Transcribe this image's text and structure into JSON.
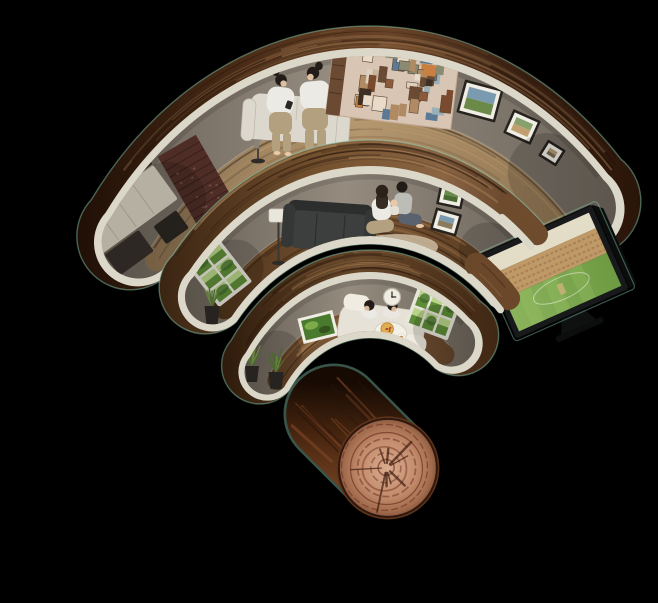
{
  "scene": {
    "alt": "Illustration of a Wi-Fi symbol built from three curved cutaway home interiors; the dot of the symbol is a cut wooden log",
    "bars": [
      {
        "name": "wifi-bar-top",
        "items": [
          "kitchen-units",
          "brick-wall",
          "yellow-floor-lamp",
          "cream-sofa",
          "couple-on-smartphones",
          "picture-collage-wall",
          "framed-pictures"
        ]
      },
      {
        "name": "wifi-bar-middle",
        "items": [
          "garden-window",
          "potted-plant",
          "white-floor-lamp",
          "charcoal-sofa",
          "family-on-rug",
          "framed-pictures",
          "sports-tv"
        ]
      },
      {
        "name": "wifi-bar-small",
        "items": [
          "green-wall-art",
          "couple-eating-on-sofa",
          "wall-clock",
          "garden-window",
          "potted-plants"
        ]
      }
    ],
    "dot": {
      "name": "wifi-dot-log"
    }
  },
  "palette": {
    "background": "#000000",
    "edge_glow": "#8fd4b8",
    "trim_cream": "#dbd7c9",
    "trim_shadow": "#b9b4a4",
    "grain_dark": "#170b04",
    "grain_light": "#c49a6a",
    "brick": "#4e2d26",
    "brick_line": "#2f1a16",
    "brick_fleck": "#8a5f50",
    "cabinet": "#d6cfc0",
    "cabinet_seam": "#b9b1a2",
    "counter_dark": "#332c25",
    "appliance_dark": "#35302a",
    "sofa_cream": "#ddd8cd",
    "sofa_cream_shadow": "#bcb6a9",
    "sofa_charcoal": "#3c3f3e",
    "sofa_charcoal_dark": "#2b2e2d",
    "lamp_yellow": "#e2a43c",
    "lamp_white": "#e9e6dc",
    "lamp_pole": "#4a4440",
    "skin": "#e9c9a8",
    "hair_dark": "#221c18",
    "hair_brown": "#2c2219",
    "shirt_white": "#eceae4",
    "tee_gray": "#bdbdb8",
    "pants_khaki": "#b3a07f",
    "jeans_blue": "#5a6270",
    "rug_beige": "#c9b89e",
    "frame_dark": "#26221e",
    "frame_mat": "#f0ede4",
    "art_green_1": "#4a7a2e",
    "art_green_2": "#8ab84e",
    "collage_base": "#d8c5b3",
    "collage_edge": "#c0a892",
    "collage_shelf": "#6b4a33",
    "collage_tones": [
      "#8a5a3a",
      "#b08a62",
      "#5a7a96",
      "#c8b49c",
      "#7a4a2e",
      "#ddd0bc",
      "#3f2f22",
      "#c97f3f",
      "#9ab0b8",
      "#6b4a33",
      "#e8dcc8",
      "#8a8a72"
    ],
    "window_frame": "#e8e5da",
    "garden_light": "#b8d488",
    "garden_dark": "#5f8c38",
    "garden_tree": "#3f6b2a",
    "plant_green_1": "#5a7a3a",
    "plant_green_2": "#7a9a4a",
    "pot_dark": "#2e2a26",
    "tv_bezel": "#17191a",
    "tv_side": "#0b0d0d",
    "tv_sky": "#e3dcc6",
    "tv_stands": "#c09a66",
    "tv_stands_dark": "#a9825a",
    "tv_pitch": "#c9b078",
    "tv_line": "#eef0e2",
    "tv_stand_leg": "#0f1111",
    "clock_face": "#efece2",
    "clock_hand": "#2a2622",
    "overlay_wood": "#6e4b2c",
    "overlay_floor": "#6b482a",
    "log_ring": "#7a3a28",
    "log_crack": "#3f1d10",
    "log_edge": "#2e1810",
    "log_bark_hi": "#7c4526",
    "log_bark_lo": "#2a140a",
    "wall_shadow": "#000000"
  },
  "gradients": {
    "gWood1": [
      [
        "0%",
        "#200f06"
      ],
      [
        "30%",
        "#4a2c17"
      ],
      [
        "55%",
        "#6b4428"
      ],
      [
        "80%",
        "#3a2112"
      ],
      [
        "100%",
        "#2a1509"
      ]
    ],
    "gWood2": [
      [
        "0%",
        "#3a2412"
      ],
      [
        "40%",
        "#75522f"
      ],
      [
        "70%",
        "#8a6443"
      ],
      [
        "100%",
        "#4c2f1a"
      ]
    ],
    "gWood3": [
      [
        "0%",
        "#2e1b0c"
      ],
      [
        "50%",
        "#684729"
      ],
      [
        "100%",
        "#3f2714"
      ]
    ],
    "gWall": [
      [
        "0%",
        "#6a6258"
      ],
      [
        "45%",
        "#958b7f"
      ],
      [
        "100%",
        "#6e665c"
      ]
    ],
    "gFloor1": [
      [
        "0%",
        "#8a7050"
      ],
      [
        "50%",
        "#b3976f"
      ],
      [
        "100%",
        "#8f7452"
      ]
    ],
    "gFloor2": [
      [
        "0%",
        "#4c3119"
      ],
      [
        "45%",
        "#7a5635"
      ],
      [
        "100%",
        "#583a20"
      ]
    ],
    "gFloor3": [
      [
        "0%",
        "#5a3c22"
      ],
      [
        "50%",
        "#8a6440"
      ],
      [
        "100%",
        "#64452a"
      ]
    ],
    "gField": [
      [
        "0%",
        "#8ab35c"
      ],
      [
        "100%",
        "#6d9a42"
      ]
    ],
    "gBark": [
      [
        "0%",
        "#160a03"
      ],
      [
        "40%",
        "#4c2811"
      ],
      [
        "70%",
        "#6e3e1f"
      ],
      [
        "100%",
        "#2e1608"
      ]
    ],
    "gFace": [
      [
        "0%",
        "#d9ab8e"
      ],
      [
        "55%",
        "#c28c6d"
      ],
      [
        "85%",
        "#a06a4c"
      ],
      [
        "100%",
        "#7e4c33"
      ]
    ]
  }
}
